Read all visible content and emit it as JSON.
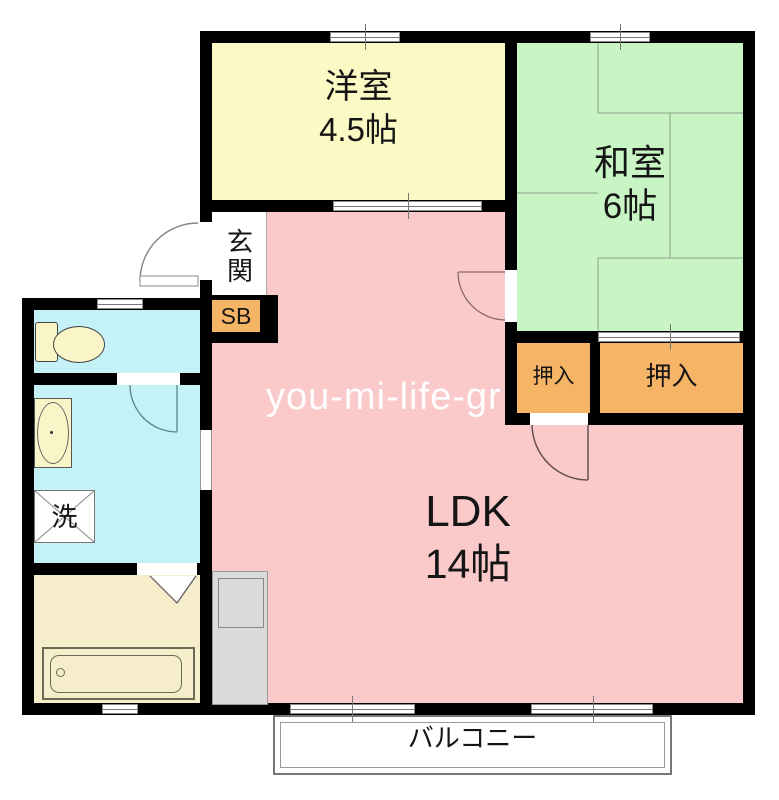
{
  "plan": {
    "watermark": "you-mi-life-gr",
    "rooms": {
      "western": {
        "name": "洋室",
        "size": "4.5帖"
      },
      "japanese": {
        "name": "和室",
        "size": "6帖"
      },
      "ldk": {
        "name": "LDK",
        "size": "14帖"
      },
      "entrance": {
        "name": "玄関"
      },
      "shoebox": {
        "name": "SB"
      },
      "closet_small": {
        "name": "押入"
      },
      "closet_large": {
        "name": "押入"
      },
      "laundry": {
        "name": "洗"
      },
      "balcony": {
        "name": "バルコニー"
      }
    },
    "colors": {
      "western": "#FBFAC4",
      "japanese": "#C9F5C5",
      "ldk": "#FACACA",
      "storage": "#F6B467",
      "wet": "#C5F2F7",
      "bath": "#F6EDCB",
      "fixture": "#FAF5C9",
      "counter": "#DBDBDB",
      "wall": "#000000",
      "tatami_line": "#8AA08A"
    }
  }
}
